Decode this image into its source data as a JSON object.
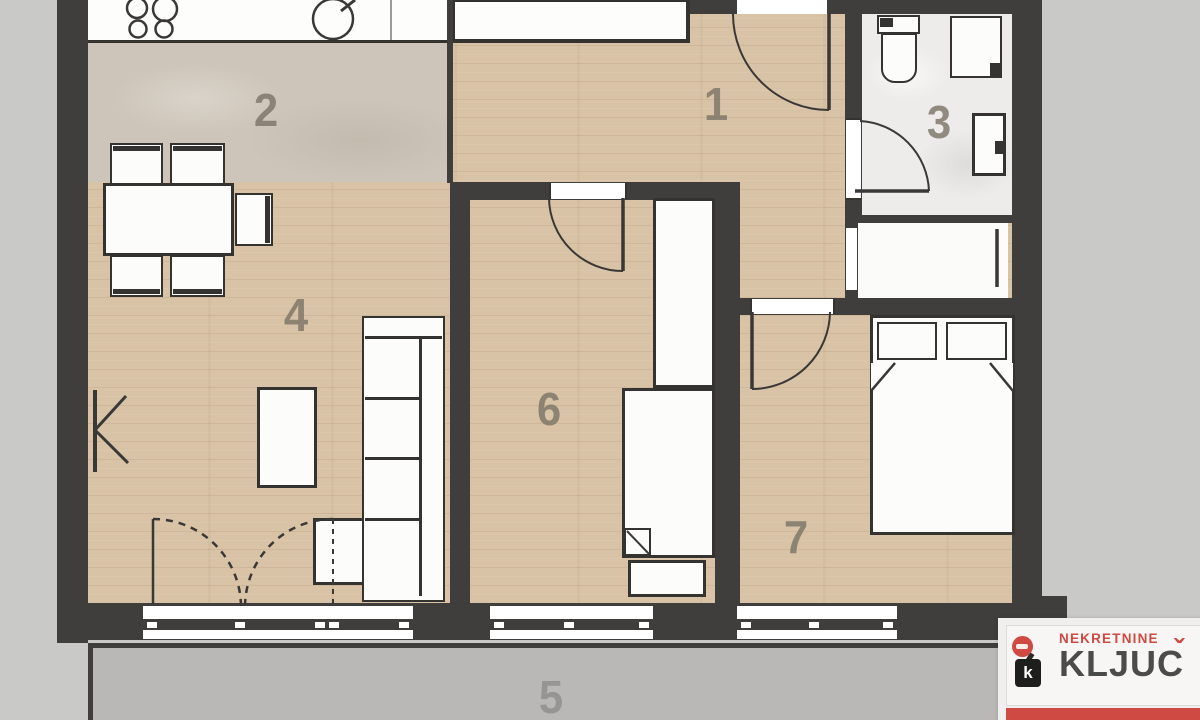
{
  "floorplan": {
    "rooms": [
      {
        "id": "room-1",
        "label": "1"
      },
      {
        "id": "room-2",
        "label": "2"
      },
      {
        "id": "room-3",
        "label": "3"
      },
      {
        "id": "room-4",
        "label": "4"
      },
      {
        "id": "room-5",
        "label": "5"
      },
      {
        "id": "room-6",
        "label": "6"
      },
      {
        "id": "room-7",
        "label": "7"
      }
    ]
  },
  "watermark": {
    "brand_top": "NEKRETNINE",
    "brand_bottom_full": "KLJUČ",
    "brand_bottom_base": "KLJUC",
    "brand_caron": "ˇ",
    "key_badge_letter": "k"
  },
  "colors": {
    "background": "#c9c9c8",
    "wall": "#3f3e3c",
    "wood_floor": "#d9c3a6",
    "kitchen_floor": "#cdc5b9",
    "bathroom_floor": "#edecea",
    "terrace_floor": "#b9b8b6",
    "furniture_fill": "#fcfcfb",
    "accent_red": "#ce4a42",
    "label_color": "#7d7568"
  }
}
